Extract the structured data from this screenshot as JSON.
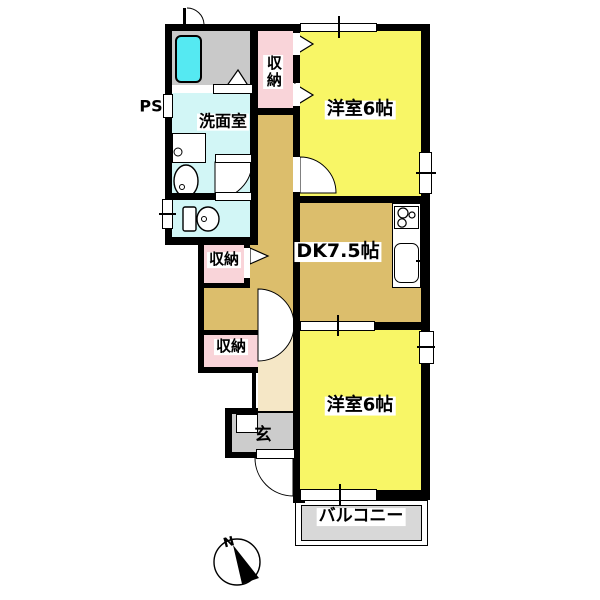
{
  "plan": {
    "rooms": {
      "washroom": {
        "label": "洗面室"
      },
      "storage_top": {
        "label": "収納"
      },
      "storage_middle": {
        "label": "収納"
      },
      "storage_bottom": {
        "label": "収納"
      },
      "bedroom_upper": {
        "label": "洋室6帖"
      },
      "dining_kitchen": {
        "label": "DK7.5帖"
      },
      "entrance": {
        "label": "玄"
      },
      "bedroom_lower": {
        "label": "洋室6帖"
      },
      "balcony": {
        "label": "バルコニー"
      }
    },
    "annotations": {
      "pipe_space": "PS",
      "compass_north": "N"
    },
    "colors": {
      "room_yellow": "#F8F666",
      "dk_tan": "#DCBE6C",
      "hall_cream": "#F5E7C6",
      "storage_pink": "#F9D4D9",
      "wet_cyan": "#D2F6F6",
      "bathtub_cyan": "#55E9F2",
      "bath_gray": "#C9C9C9",
      "genkan_gray": "#CCCCCC",
      "balcony_gray": "#D8D8D8",
      "wall_black": "#000000"
    }
  }
}
